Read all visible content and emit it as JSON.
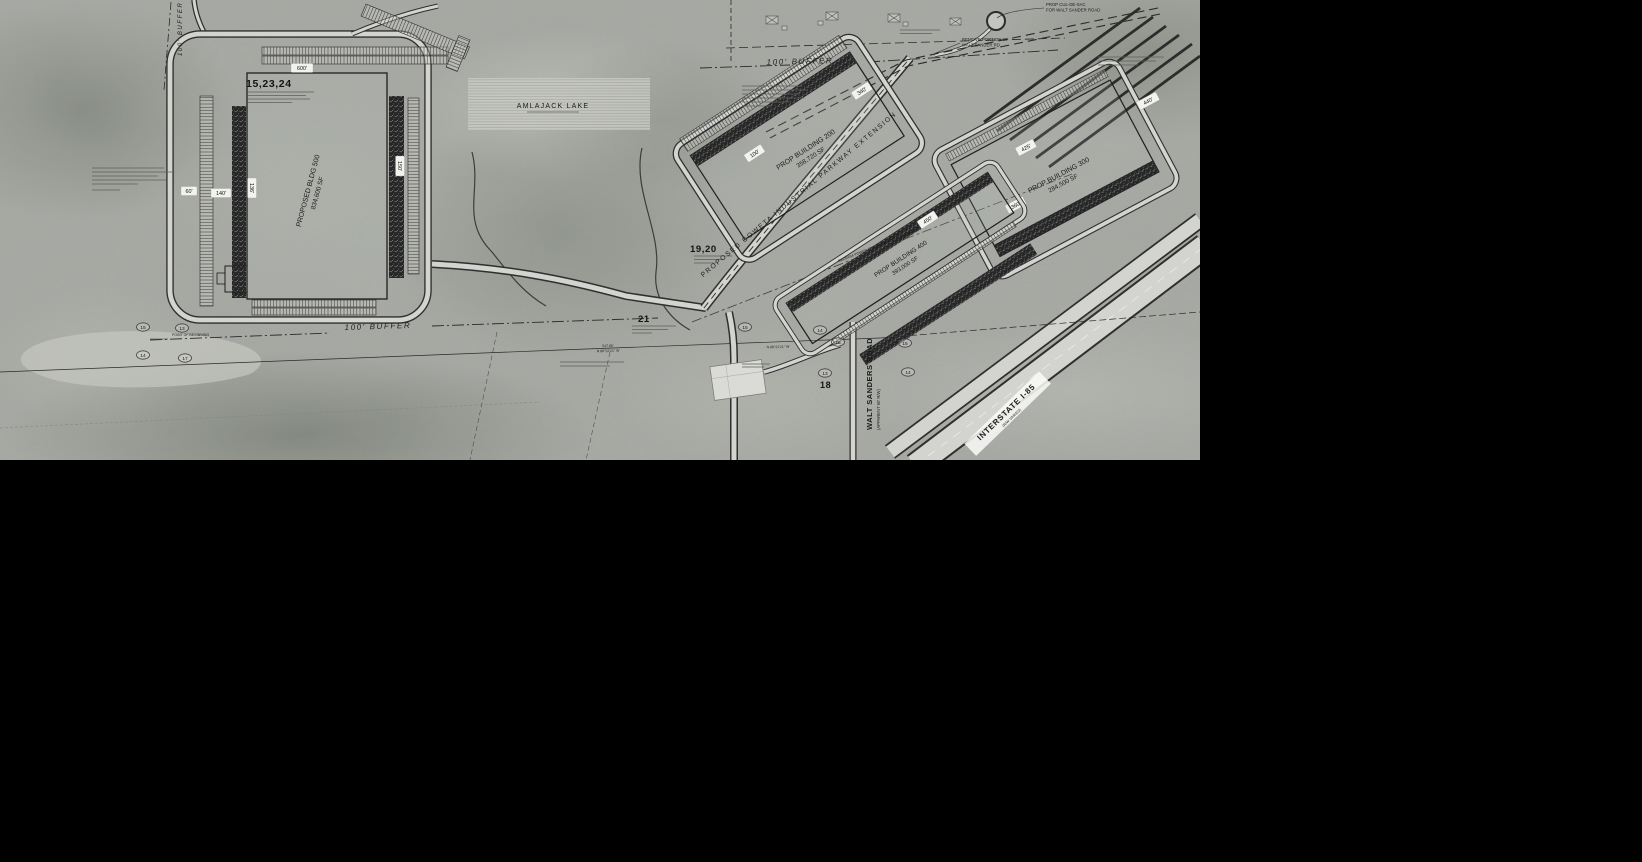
{
  "site_plan": {
    "parcels": [
      {
        "label": "15,23,24"
      },
      {
        "label": "19,20"
      },
      {
        "label": "21"
      },
      {
        "label": "18"
      }
    ],
    "buildings": [
      {
        "name": "PROPOSED BLDG 500",
        "area": "834,600 SF"
      },
      {
        "name": "PROP BUILDING 200",
        "area": "358,720 SF"
      },
      {
        "name": "PROP BUILDING 300",
        "area": "284,500 SF"
      },
      {
        "name": "PROP BUILDING 400",
        "area": "393,000 SF"
      }
    ],
    "roads": {
      "parkway": "PROPOSED COWETA INDUSTRIAL PARKWAY EXTENSION",
      "walt_sanders": "WALT SANDERS ROAD",
      "walt_sanders_sub": "(APPARENT 60' R/W)",
      "interstate": "INTERSTATE I-85",
      "interstate_sub": "(R/W VARIES)"
    },
    "notes": {
      "culdesac_1": "PROP CUL-DE-SAC",
      "culdesac_2": "FOR WALT SANDER ROAD",
      "remove_1": "REMOVE PORTION OF",
      "remove_2": "WALT SANDER RD.",
      "transmission": "GEORGIA POWER TRANSMISSION LINE EASEMENT",
      "pob": "POINT OF BEGINNING"
    },
    "buffers": {
      "top": "100' BUFFER",
      "west": "100' BUFFER",
      "south": "100' BUFFER"
    },
    "water": {
      "lake": "AMLAJACK LAKE"
    },
    "survey": {
      "distance": "547.80'",
      "bearing": "N 88°22'21\" W"
    },
    "dimensions": [
      {
        "value": "600'"
      },
      {
        "value": "60'"
      },
      {
        "value": "140'"
      },
      {
        "value": "136'"
      },
      {
        "value": "150'"
      },
      {
        "value": "100'"
      },
      {
        "value": "340'"
      },
      {
        "value": "425'"
      },
      {
        "value": "360'"
      },
      {
        "value": "440'"
      },
      {
        "value": "450'"
      }
    ],
    "ref_bubbles": [
      {
        "value": "15"
      },
      {
        "value": "13"
      },
      {
        "value": "14"
      },
      {
        "value": "17"
      },
      {
        "value": "15"
      },
      {
        "value": "14"
      },
      {
        "value": "16"
      },
      {
        "value": "15"
      },
      {
        "value": "13"
      },
      {
        "value": "14"
      }
    ]
  }
}
